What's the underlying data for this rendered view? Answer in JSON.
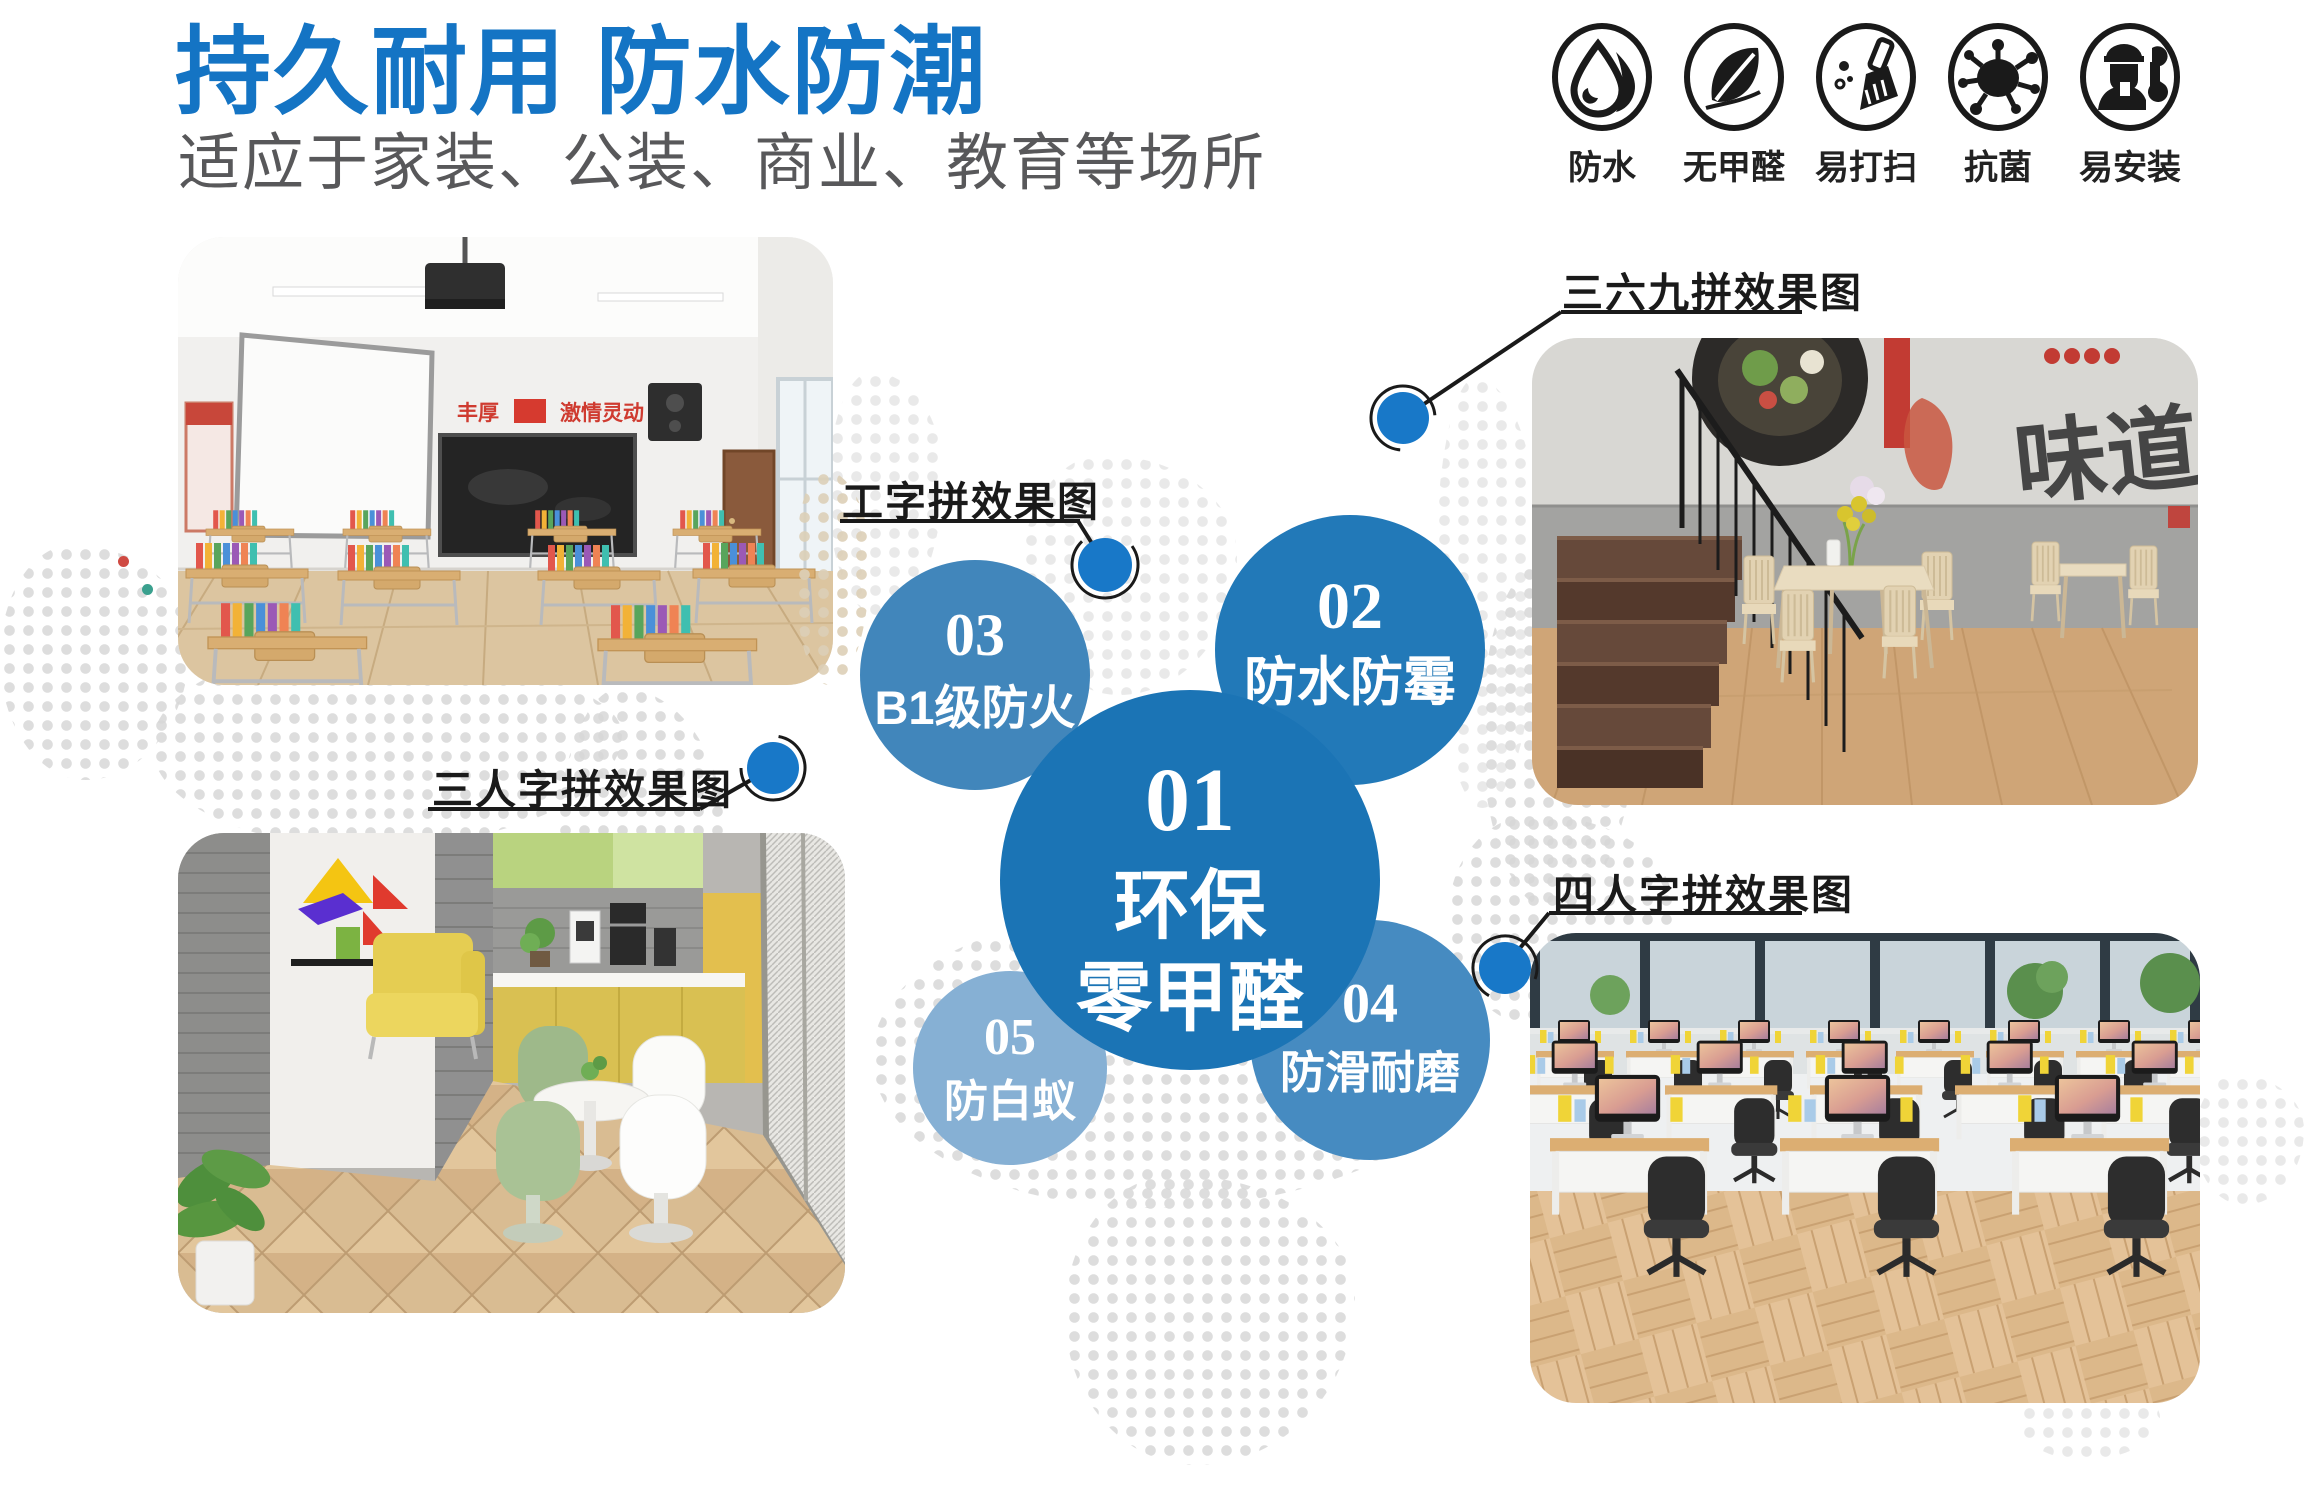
{
  "header": {
    "title": "持久耐用 防水防潮",
    "subtitle": "适应于家装、公装、商业、教育等场所"
  },
  "features": {
    "items": [
      {
        "icon": "waterdrop-icon",
        "label": "防水"
      },
      {
        "icon": "leaf-icon",
        "label": "无甲醛"
      },
      {
        "icon": "cleaning-brush-icon",
        "label": "易打扫"
      },
      {
        "icon": "germ-icon",
        "label": "抗菌"
      },
      {
        "icon": "installer-wrench-icon",
        "label": "易安装"
      }
    ]
  },
  "bubbles": {
    "b1": {
      "num": "01",
      "line1": "环保",
      "line2": "零甲醛",
      "color": "#1b74b5"
    },
    "b2": {
      "num": "02",
      "text": "防水防霉",
      "color": "#2279b8"
    },
    "b3": {
      "num": "03",
      "text": "B1级防火",
      "color": "#4186bb"
    },
    "b4": {
      "num": "04",
      "text": "防滑耐磨",
      "color": "#468bc1"
    },
    "b5": {
      "num": "05",
      "text": "防白蚁",
      "color": "#86b0d4"
    }
  },
  "callouts": {
    "c1": {
      "label": "工字拼效果图"
    },
    "c2": {
      "label": "三六九拼效果图"
    },
    "c3": {
      "label": "三人字拼效果图"
    },
    "c4": {
      "label": "四人字拼效果图"
    }
  },
  "photos": {
    "classroom": {
      "banner_left": "丰厚",
      "banner_right": "激情灵动"
    },
    "restaurant": {
      "mural_text": "味道"
    }
  },
  "colors": {
    "accent_blue": "#1474c4",
    "callout_dot_blue": "#1878c8",
    "map_dot_gray": "#d8d8d8",
    "map_dot_tan": "#ddd0b8",
    "line_black": "#1a1a1a"
  }
}
